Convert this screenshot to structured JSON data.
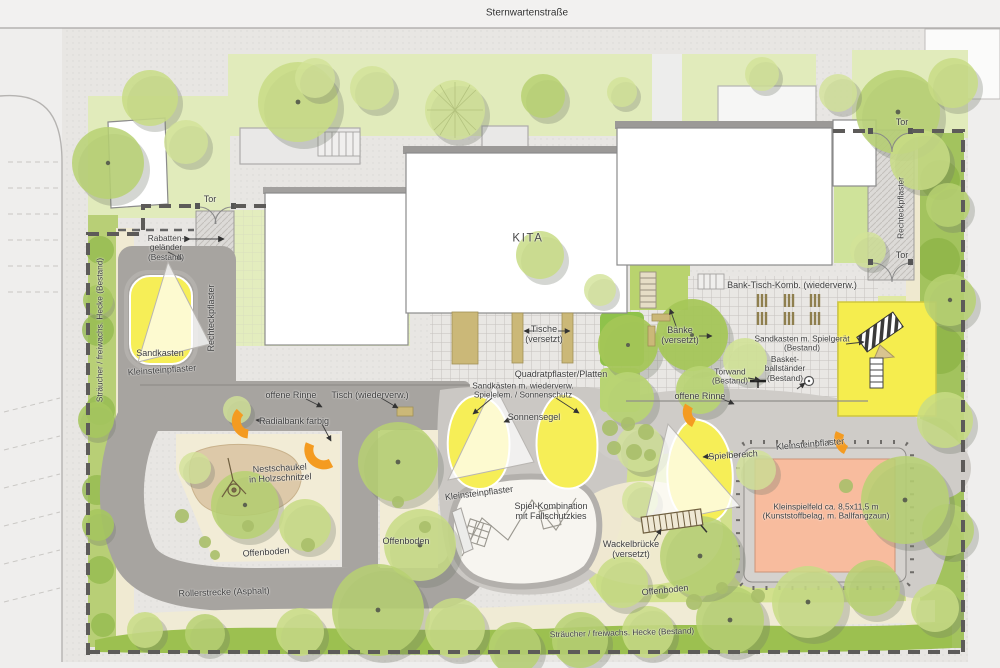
{
  "plan_title": "KITA Freianlagen Lageplan",
  "labels": {
    "street": "Sternwartenstraße",
    "kita": "KITA",
    "tor": "Tor",
    "rabatten_1": "Rabatten-",
    "rabatten_2": "geländer",
    "rabatten_3": "(Bestand)",
    "sandkasten": "Sandkasten",
    "kleinsteinpflaster": "Kleinsteinpflaster",
    "rechteckpflaster": "Rechteckpflaster",
    "hecke": "Sträucher / freiwachs. Hecke (Bestand)",
    "tische_1": "Tische",
    "tische_2": "(versetzt)",
    "quadratpflaster": "Quadratpflaster/Platten",
    "sandkaesten_1": "Sandkästen m. wiederverw.",
    "sandkaesten_2": "Spielelem. / Sonnenschutz",
    "sonnensegel": "Sonnensegel",
    "offene_rinne": "offene Rinne",
    "tisch_wiederverw": "Tisch (wiederverw.)",
    "radialbank": "Radialbank farbig",
    "nestschaukel_1": "Nestschaukel",
    "nestschaukel_2": "in Holzschnitzel",
    "offenboden": "Offenboden",
    "rollerstrecke": "Rollerstrecke (Asphalt)",
    "spielkombination_1": "Spiel-Kombination",
    "spielkombination_2": "mit Fallschutzkies",
    "wackelbruecke_1": "Wackelbrücke",
    "wackelbruecke_2": "(versetzt)",
    "baenke_1": "Bänke",
    "baenke_2": "(versetzt)",
    "bank_tisch_komb": "Bank-Tisch-Komb. (wiederverw.)",
    "sandkasten_spielgeraet_1": "Sandkasten m. Spielgerät",
    "sandkasten_spielgeraet_2": "(Bestand)",
    "basketball_1": "Basket-",
    "basketball_2": "ballständer",
    "basketball_3": "(Bestand)",
    "torwand_1": "Torwand",
    "torwand_2": "(Bestand)",
    "spielbereich": "Spielbereich",
    "kleinspielfeld_1": "Kleinspielfeld ca. 8,5x11,5 m",
    "kleinspielfeld_2": "(Kunststoffbelag, m.  Ballfangzaun)"
  },
  "colors": {
    "sand_yellow": "#f6ee57",
    "spielfeld_salmon": "#f8bc9e",
    "bench_orange": "#f49b21",
    "lawn_green": "#e1ebbb",
    "hedge_green": "#9cc050",
    "tree_green": "#b7d172",
    "asphalt_gray": "#a7a4a0",
    "paving_gray": "#cbc8c4",
    "woodchip_tan": "#ddc9a9",
    "building_white": "#ffffff"
  }
}
